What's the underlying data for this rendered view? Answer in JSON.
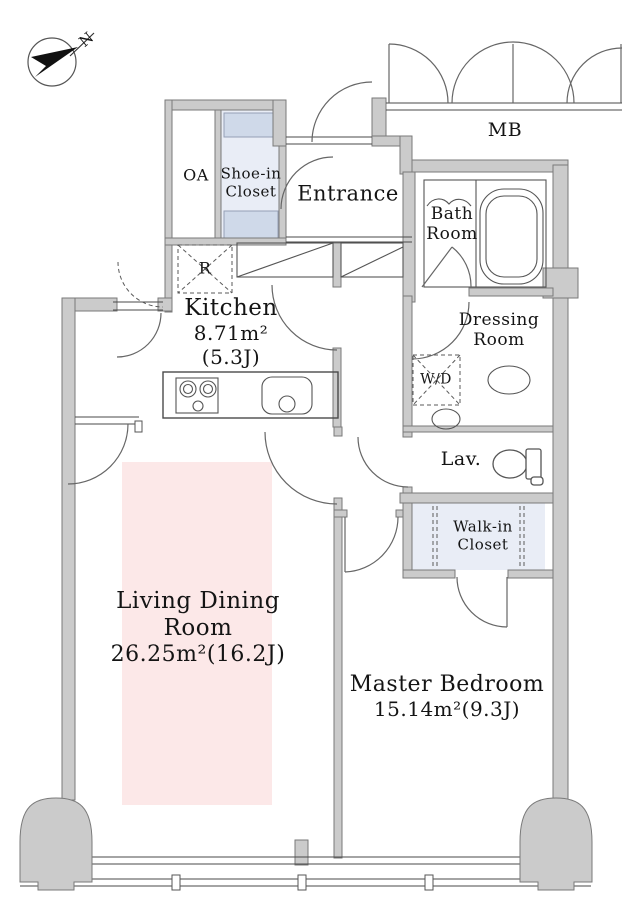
{
  "colors": {
    "wall_fill": "#cbcbcb",
    "wall_outline": "#7a7a7a",
    "line": "#4a4a4a",
    "arc": "#666666",
    "closet_fill": "#e9edf6",
    "shelf_fill": "#cfd9e9",
    "living_fill": "#fce8e8",
    "text": "#141414"
  },
  "compass": {
    "label": "N"
  },
  "rooms": {
    "entrance": {
      "label": "Entrance"
    },
    "meter_box": {
      "label": "MB"
    },
    "open_air": {
      "label": "OA"
    },
    "shoe_in_closet": {
      "line1": "Shoe-in",
      "line2": "Closet"
    },
    "bath": {
      "line1": "Bath",
      "line2": "Room"
    },
    "dressing": {
      "line1": "Dressing",
      "line2": "Room"
    },
    "washer_dryer": {
      "label": "W/D"
    },
    "lavatory": {
      "label": "Lav."
    },
    "walk_in_closet": {
      "line1": "Walk-in",
      "line2": "Closet"
    },
    "refrigerator": {
      "label": "R"
    },
    "kitchen": {
      "name": "Kitchen",
      "area_m2": "8.71m²",
      "area_jo": "(5.3J)"
    },
    "living_dining": {
      "name_line1": "Living Dining",
      "name_line2": "Room",
      "area": "26.25m²(16.2J)"
    },
    "master_bedroom": {
      "name": "Master Bedroom",
      "area": "15.14m²(9.3J)"
    }
  }
}
